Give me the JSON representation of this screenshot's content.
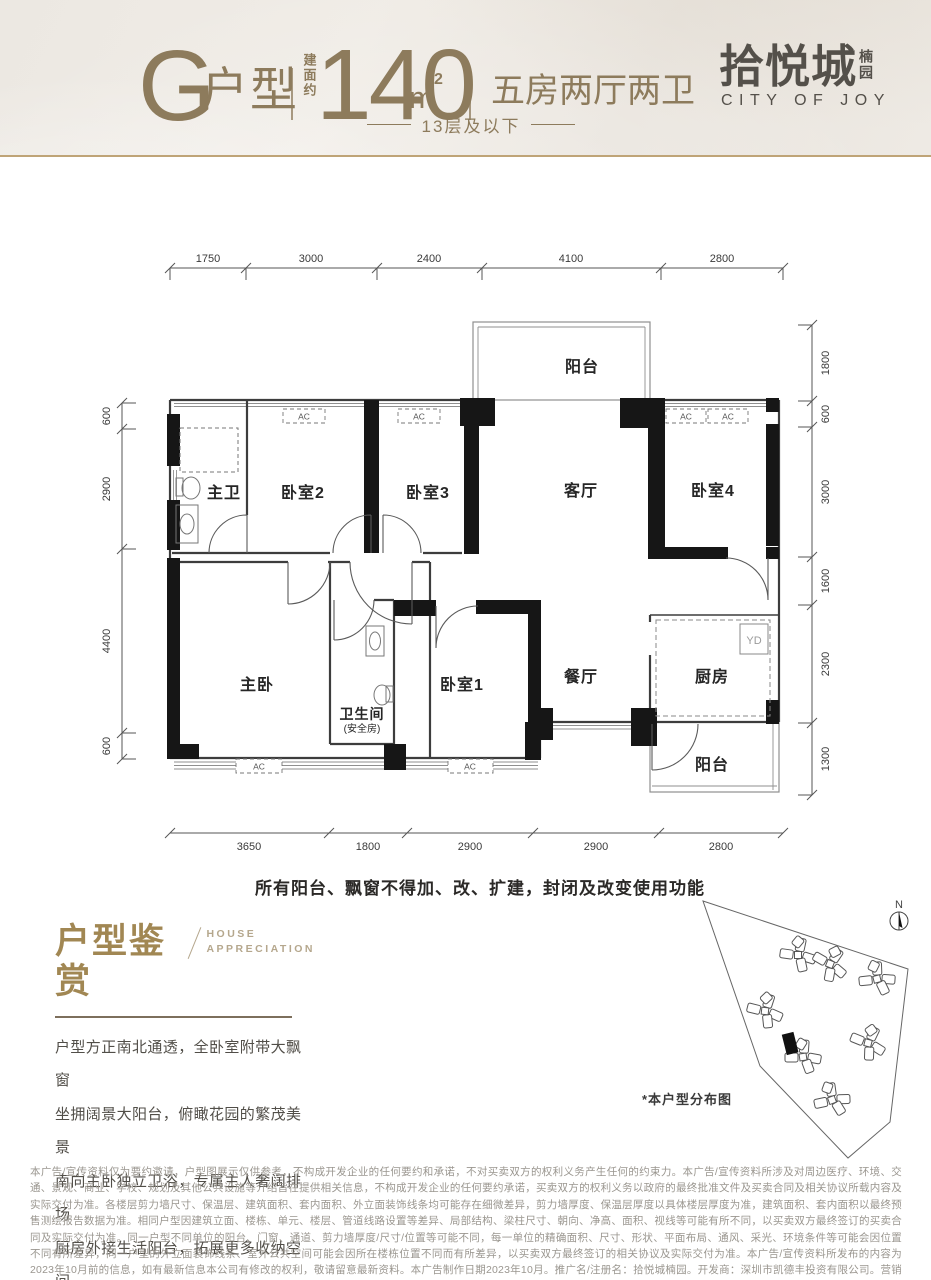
{
  "colors": {
    "accent_bronze": "#8d7b5c",
    "gold_rule": "#bfa477",
    "logo_gray": "#54504a",
    "appre_gold": "#a18753",
    "wall_black": "#161616"
  },
  "header": {
    "unit": "G",
    "unit_suffix": "户型",
    "area_prefix": "建面约",
    "area_value": "140",
    "area_unit": "m",
    "area_sup": "2",
    "rooms_label": "五房两厅两卫",
    "floors": "13层及以下",
    "logo_cn": "拾悦城",
    "logo_sub": "楠园",
    "logo_en": "CITY OF JOY"
  },
  "plan": {
    "dims_top": [
      "1750",
      "3000",
      "2400",
      "4100",
      "2800"
    ],
    "dims_bottom": [
      "3650",
      "1800",
      "2900",
      "2900",
      "2800"
    ],
    "dims_left": [
      "600",
      "2900",
      "4400",
      "600"
    ],
    "dims_right": [
      "1800",
      "600",
      "3000",
      "1600",
      "2300",
      "1300"
    ],
    "rooms": {
      "balcony_top": "阳台",
      "master_bath": "主卫",
      "bedroom2": "卧室2",
      "bedroom3": "卧室3",
      "living": "客厅",
      "bedroom4": "卧室4",
      "master": "主卧",
      "bath": "卫生间",
      "bath_sub": "(安全房)",
      "bedroom1": "卧室1",
      "dining": "餐厅",
      "kitchen": "厨房",
      "balcony_bottom": "阳台"
    },
    "ac": "AC",
    "yd": "YD",
    "note": "所有阳台、飘窗不得加、改、扩建，封闭及改变使用功能"
  },
  "appreciation": {
    "title": "户型鉴赏",
    "subtitle1": "HOUSE",
    "subtitle2": "APPRECIATION",
    "lines": [
      "户型方正南北通透，全卧室附带大飘窗",
      "坐拥阔景大阳台，俯瞰花园的繁茂美景",
      "南向主卧独立卫浴，专属主人奢阔排场",
      "厨房外接生活阳台，拓展更多收纳空间"
    ]
  },
  "sitemap": {
    "caption": "*本户型分布图",
    "compass_n": "N"
  },
  "disclaimer": {
    "text": "本广告/宣传资料仅为要约邀请，户型图展示仅供参考，不构成开发企业的任何要约和承诺，不对买卖双方的权利义务产生任何的约束力。本广告/宣传资料所涉及对周边医疗、环境、交通、景观、商业、学校、规划及其他公共设施等介绍旨在提供相关信息，不构成开发企业的任何要约承诺，买卖双方的权利义务以政府的最终批准文件及买卖合同及相关协议所载内容及实际交付为准。各楼层剪力墙尺寸、保温层、建筑面积、套内面积、外立面装饰线条均可能存在细微差异，剪力墙厚度、保温层厚度以具体楼层厚度为准，建筑面积、套内面积以最终预售测绘报告数据为准。相同户型因建筑立面、楼栋、单元、楼层、管道线路设置等差异、局部结构、梁柱尺寸、朝向、净高、面积、视线等可能有所不同，以买卖双方最终签订的买卖合同及实际交付为准。同一户型不同单位的阳台、门窗、通道、剪力墙厚度/尺寸/位置等可能不同，每一单位的精确面积、尺寸、形状、平面布局、通风、采光、环境条件等可能会因位置不同有所差异，同一户型的外立面装饰线条、室外公共空间可能会因所在楼栋位置不同而有所差异，以买卖双方最终签订的相关协议及实际交付为准。本广告/宣传资料所发布的内容为2023年10月前的信息，如有最新信息本公司有修改的权利，敬请留意最新资料。本广告制作日期2023年10月。推广名/注册名：拾悦城楠园。开发商：深圳市凯德丰投资有限公司。营销代理：中原地产代理(深圳)有限公司。预售许可证：深房许字(2023)宝安034号。"
  }
}
